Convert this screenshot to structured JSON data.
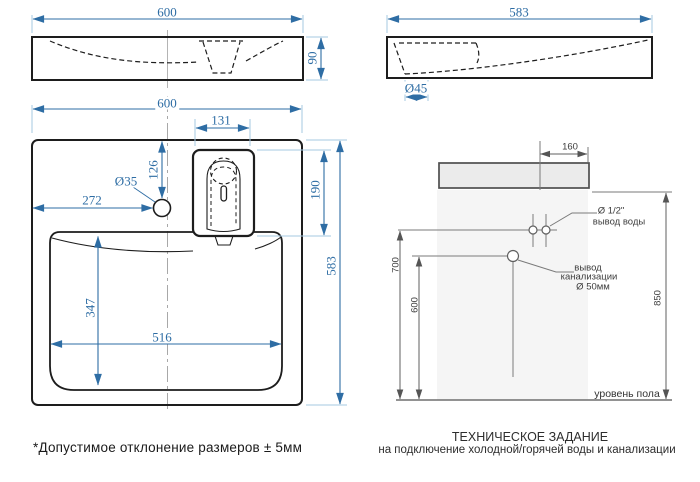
{
  "colors": {
    "dim_blue": "#2e6da4",
    "ext_blue": "#a5c8e1",
    "line_black": "#1d1d1d",
    "gray_line": "#7a7a7a",
    "wall_fill": "#f5f5f5",
    "block_fill": "#ebebeb"
  },
  "front_view": {
    "width": "600",
    "height": "90"
  },
  "side_view": {
    "width": "583",
    "drain_diameter": "Ø45"
  },
  "plan_view": {
    "width": "600",
    "tray_width": "131",
    "tap_offset_top": "126",
    "tap_diameter": "Ø35",
    "tap_offset_left": "272",
    "tray_depth": "190",
    "depth": "583",
    "bowl_depth": "347",
    "bowl_width": "516"
  },
  "elevation": {
    "block_offset": "160",
    "water_diameter": "Ø 1/2\"",
    "water_label": "вывод воды",
    "water_height": "700",
    "drain_height": "600",
    "drain_label_line1": "вывод",
    "drain_label_line2": "канализации",
    "drain_diameter": "Ø 50мм",
    "total_height": "850",
    "floor_label": "уровень пола"
  },
  "footer": {
    "note": "*Допустимое отклонение размеров ± 5мм",
    "title": "ТЕХНИЧЕСКОЕ ЗАДАНИЕ",
    "subtitle": "на подключение холодной/горячей воды и канализации"
  }
}
